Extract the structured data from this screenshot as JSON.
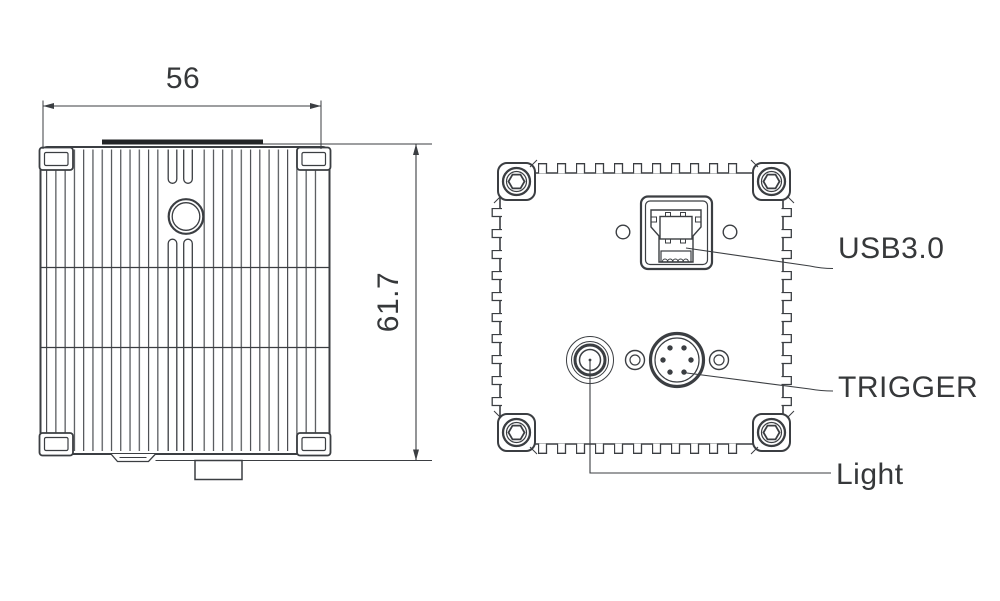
{
  "dimensions": {
    "width": "56",
    "height": "61.7"
  },
  "labels": {
    "usb": "USB3.0",
    "trigger": "TRIGGER",
    "light": "Light"
  },
  "components": {
    "side_view": [
      "heatsink-fins",
      "mount-hole",
      "mount-slots",
      "corner-clips",
      "bottom-connector-block"
    ],
    "back_view": [
      "corner-hex-screws",
      "usb3-port",
      "trigger-connector",
      "light-connector",
      "screw-holes"
    ]
  },
  "colors": {
    "line": "#3b3e42",
    "line_dark": "#232527",
    "text": "#36383a",
    "background": "#ffffff"
  }
}
